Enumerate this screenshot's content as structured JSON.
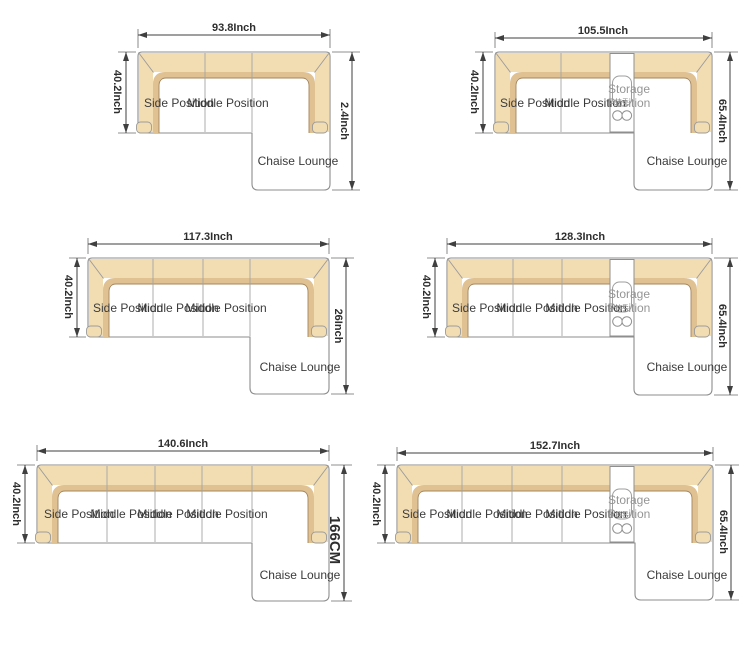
{
  "colors": {
    "sofa_fill": "#f2ddb3",
    "sofa_lip": "#dfc192",
    "lip_line": "#a5875c",
    "outline": "#8c8c8c",
    "dimension_text": "#2e2e2e",
    "label_text": "#3b3b3b",
    "storage_text": "#959595",
    "background": "#ffffff"
  },
  "diagrams": [
    {
      "top_width": "93.8Inch",
      "side_depth": "40.2Inch",
      "right_depth": "2.4Inch",
      "seats": [
        "Side Position",
        "Middle Position"
      ],
      "chaise": "Chaise Lounge"
    },
    {
      "top_width": "105.5Inch",
      "side_depth": "40.2Inch",
      "right_depth": "65.4Inch",
      "seats": [
        "Side Position",
        "Middle Position"
      ],
      "storage": {
        "line1": "Storage",
        "line2": "Position",
        "glyph": "扶手"
      },
      "chaise": "Chaise Lounge"
    },
    {
      "top_width": "117.3Inch",
      "side_depth": "40.2Inch",
      "right_depth": "26Inch",
      "seats": [
        "Side Position",
        "Middle Position",
        "Middle Position"
      ],
      "chaise": "Chaise Lounge"
    },
    {
      "top_width": "128.3Inch",
      "side_depth": "40.2Inch",
      "right_depth": "65.4Inch",
      "seats": [
        "Side Position",
        "Middle Position",
        "Middle Position"
      ],
      "storage": {
        "line1": "Storage",
        "line2": "Position",
        "glyph": "扶手"
      },
      "chaise": "Chaise Lounge"
    },
    {
      "top_width": "140.6Inch",
      "side_depth": "40.2Inch",
      "right_depth": "166CM",
      "seats": [
        "Side Position",
        "Middle Position",
        "Middle Position",
        "Middle Position"
      ],
      "chaise": "Chaise Lounge"
    },
    {
      "top_width": "152.7Inch",
      "side_depth": "40.2Inch",
      "right_depth": "65.4Inch",
      "seats": [
        "Side Position",
        "Middle Position",
        "Middle Position",
        "Middle Position"
      ],
      "storage": {
        "line1": "Storage",
        "line2": "Position",
        "glyph": "扶手"
      },
      "chaise": "Chaise Lounge"
    }
  ]
}
